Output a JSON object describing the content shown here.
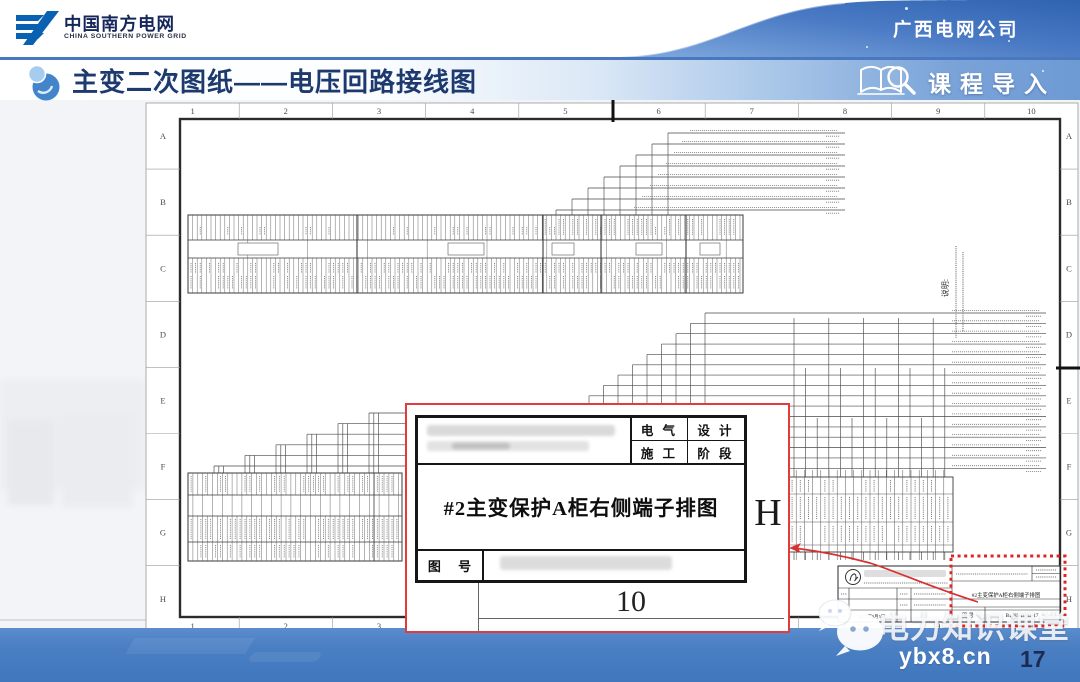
{
  "header": {
    "logo_title": "中国南方电网",
    "logo_subtitle": "CHINA SOUTHERN POWER GRID",
    "region_company": "广西电网公司"
  },
  "title_bar": {
    "title": "主变二次图纸——电压回路接线图",
    "course_label": "课程导入"
  },
  "sheet": {
    "column_labels": [
      "1",
      "2",
      "3",
      "4",
      "5",
      "6",
      "7",
      "8",
      "9",
      "10"
    ],
    "row_labels": [
      "A",
      "B",
      "C",
      "D",
      "E",
      "F",
      "G",
      "H"
    ],
    "notes_label": "说明:"
  },
  "title_block": {
    "drawing_title": "#2主变保护A柜右侧端子排图",
    "drawing_no_label": "图 号",
    "drawing_no": "B1485-D202-17",
    "date": "2017年9月5日"
  },
  "callout": {
    "field_electric": "电 气",
    "field_design": "设 计",
    "field_construction": "施 工",
    "field_phase": "阶 段",
    "drawing_no_label": "图 号",
    "drawing_title": "#2主变保护A柜右侧端子排图",
    "column_number": "10",
    "row_letter": "H"
  },
  "footer": {
    "watermark": "电力知识课堂",
    "website": "ybx8.cn",
    "page_number": "17"
  },
  "colors": {
    "accent_blue": "#2e62ad",
    "band_blue": "#4a80c3",
    "callout_red": "#e23b3b",
    "title_navy": "#1d3a6f"
  }
}
